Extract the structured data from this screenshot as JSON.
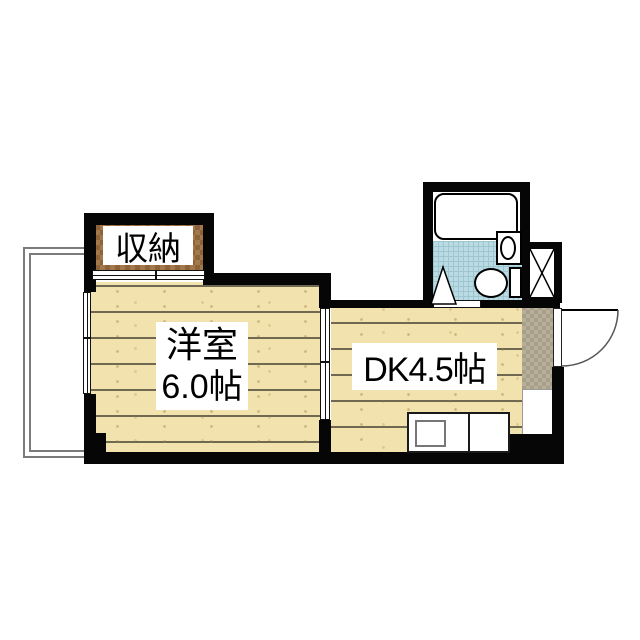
{
  "plan": {
    "type": "apartment-floorplan",
    "rooms": {
      "closet": {
        "label": "収納"
      },
      "western_room": {
        "name": "洋室",
        "size": "6.0帖"
      },
      "dining_kitchen": {
        "label": "DK4.5帖"
      }
    },
    "features": {
      "balcony": "balcony",
      "window": "sliding-window",
      "closet_door": "sliding-door",
      "room_divider_door": "sliding-door",
      "bathroom": {
        "bathtub": "bathtub",
        "toilet": "toilet",
        "washbasin": "washbasin",
        "door": "bath-door",
        "swing_mark": "door-swing-triangle"
      },
      "pipe_space": "pipe-space-x-box",
      "entrance": "genkan",
      "entry_door": "outward-swing-door",
      "kitchen": {
        "counter": "kitchen-counter",
        "sink": "sink"
      }
    },
    "colors": {
      "wall": "#060606",
      "wood_floor": "#f2e3ae",
      "plank_line": "#6e6950",
      "closet_wood_light": "#a3784a",
      "closet_wood_dark": "#8d6439",
      "bath_floor": "#badbe3",
      "bath_grid": "#9dc6cf",
      "genkan_floor": "#b1a992",
      "balcony_line": "#7b7b7b",
      "label_bg": "#ffffff",
      "text": "#000000"
    }
  }
}
